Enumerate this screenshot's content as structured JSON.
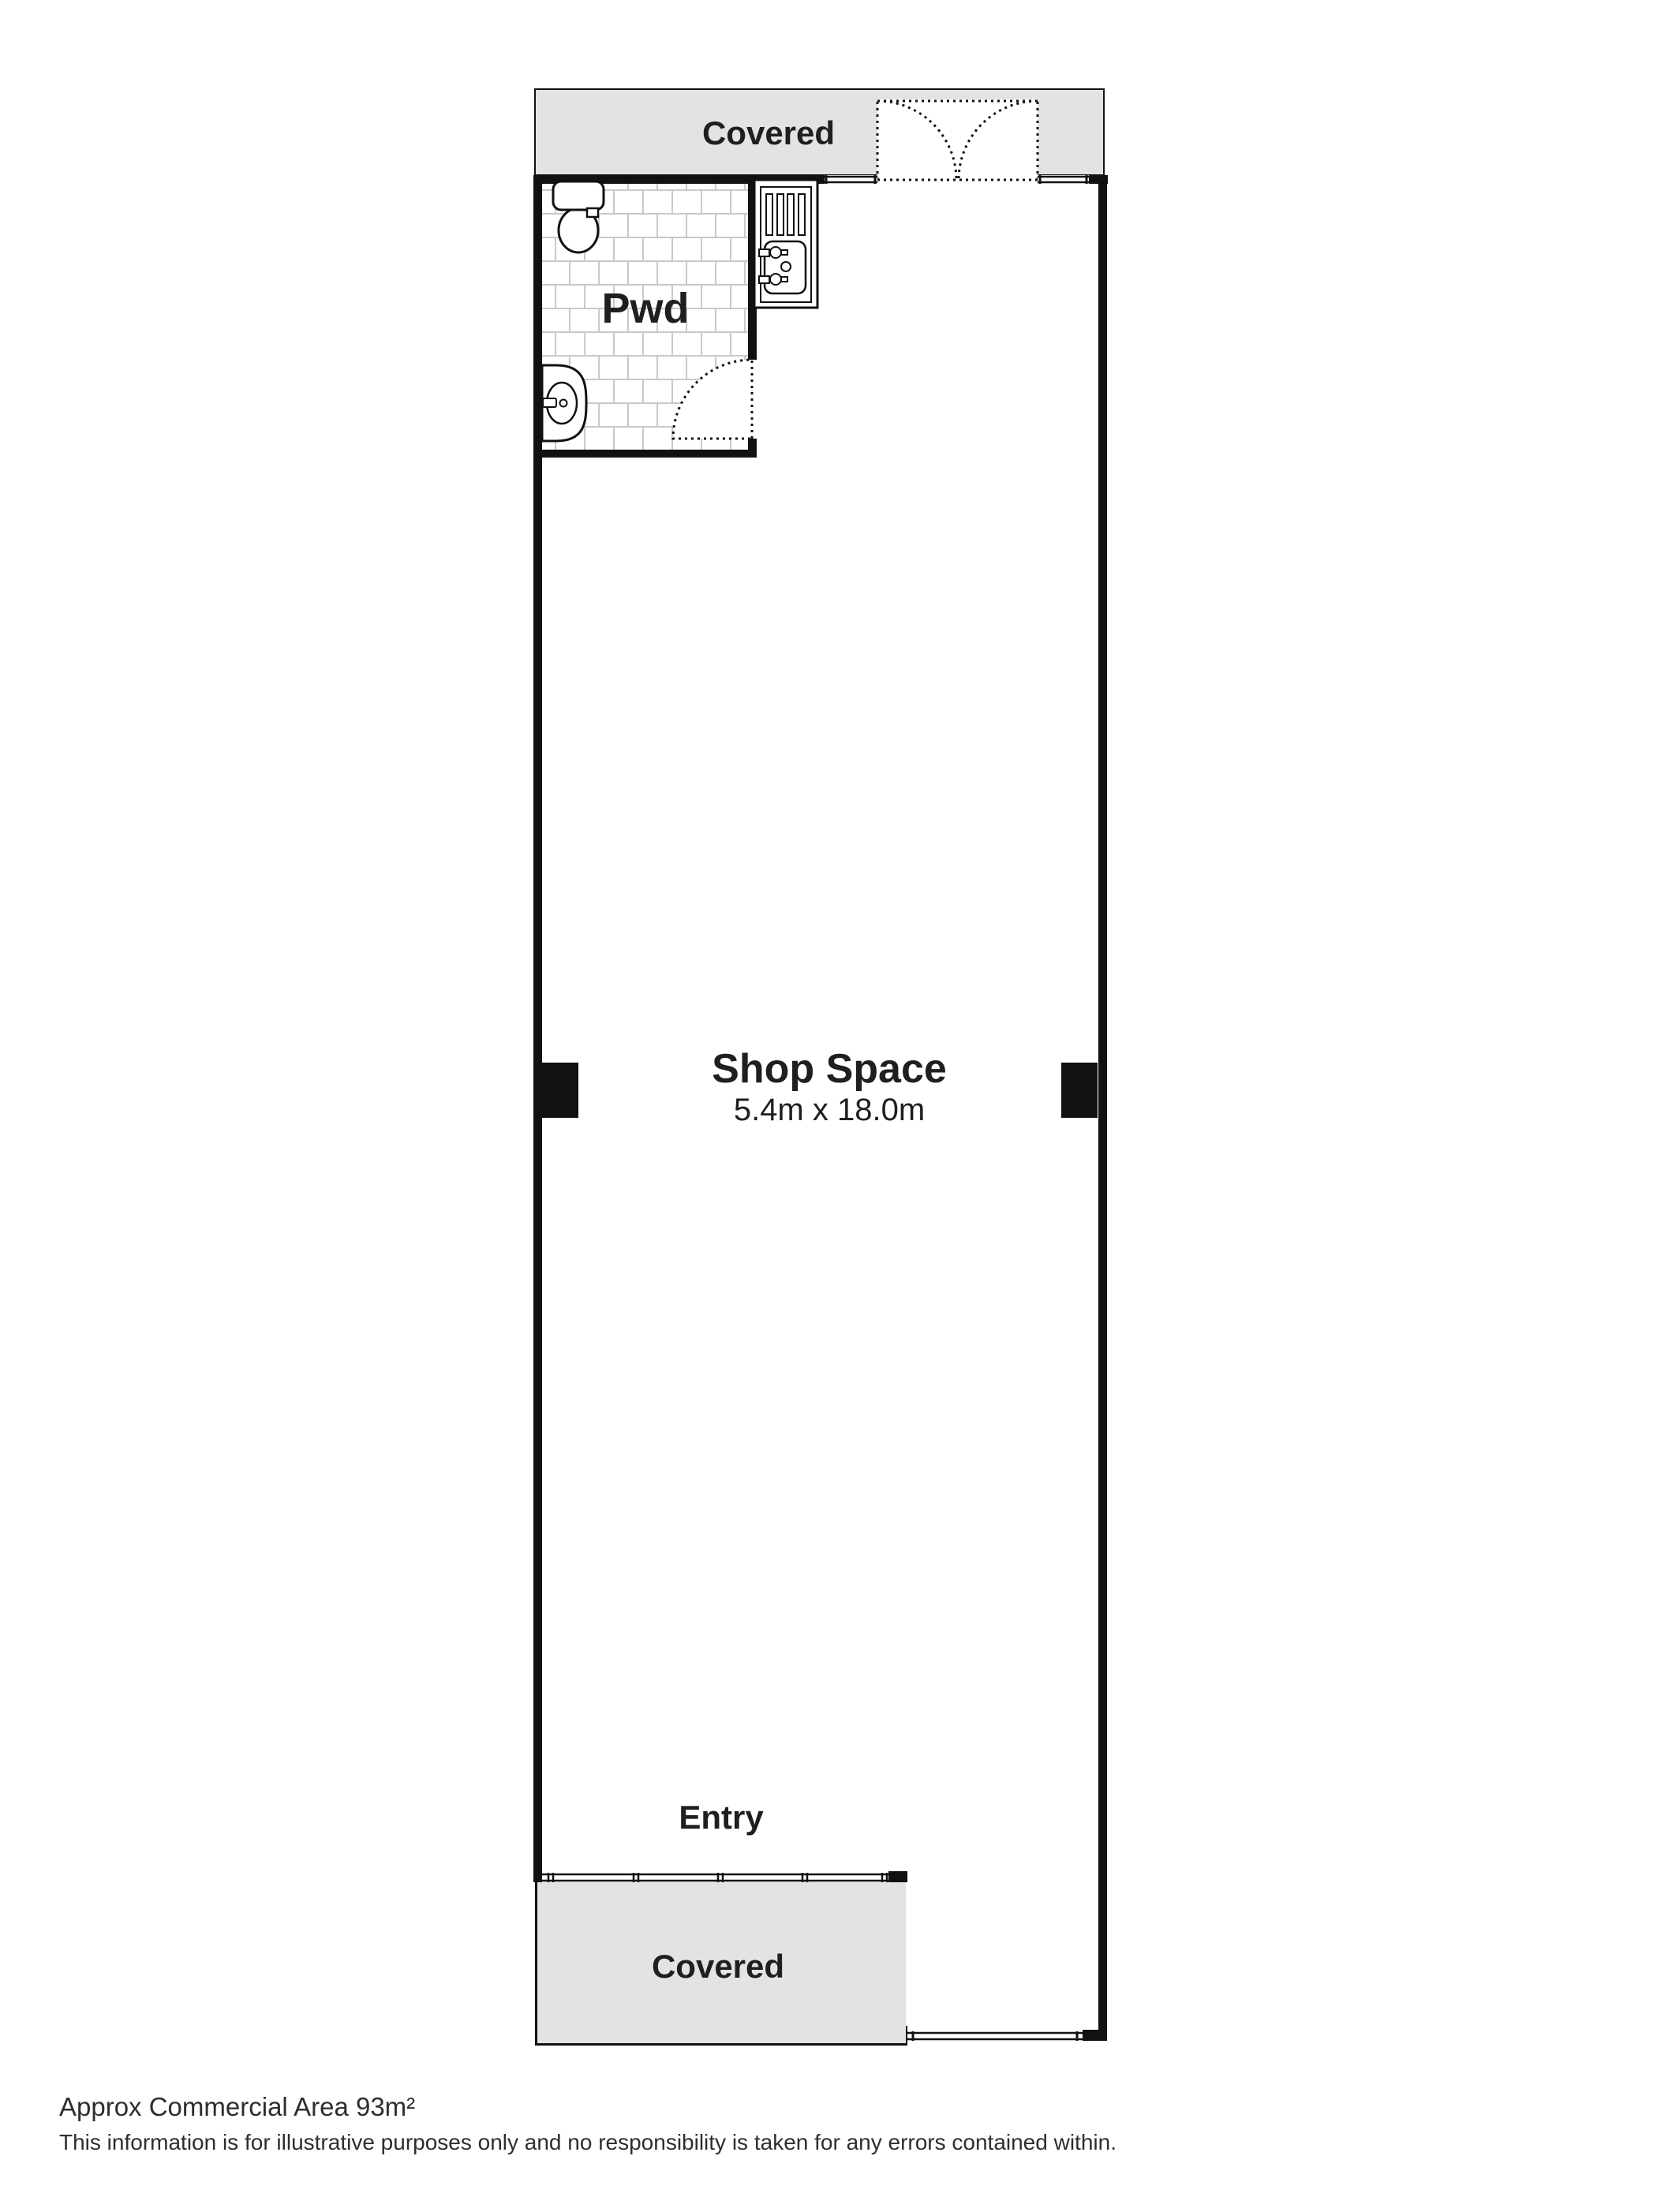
{
  "rooms": {
    "covered_top": "Covered",
    "pwd": "Pwd",
    "shop_title": "Shop Space",
    "shop_dims": "5.4m x 18.0m",
    "entry": "Entry",
    "covered_bottom": "Covered"
  },
  "footer": {
    "area": "Approx Commercial Area 93m²",
    "disclaimer": "This information is for illustrative purposes only and no responsibility is taken for any errors contained within."
  },
  "colors": {
    "wall": "#111111",
    "covered": "#e3e3e3",
    "grout": "#c9c9c9",
    "label": "#1f1f1f",
    "footer": "#2e2e2e"
  }
}
